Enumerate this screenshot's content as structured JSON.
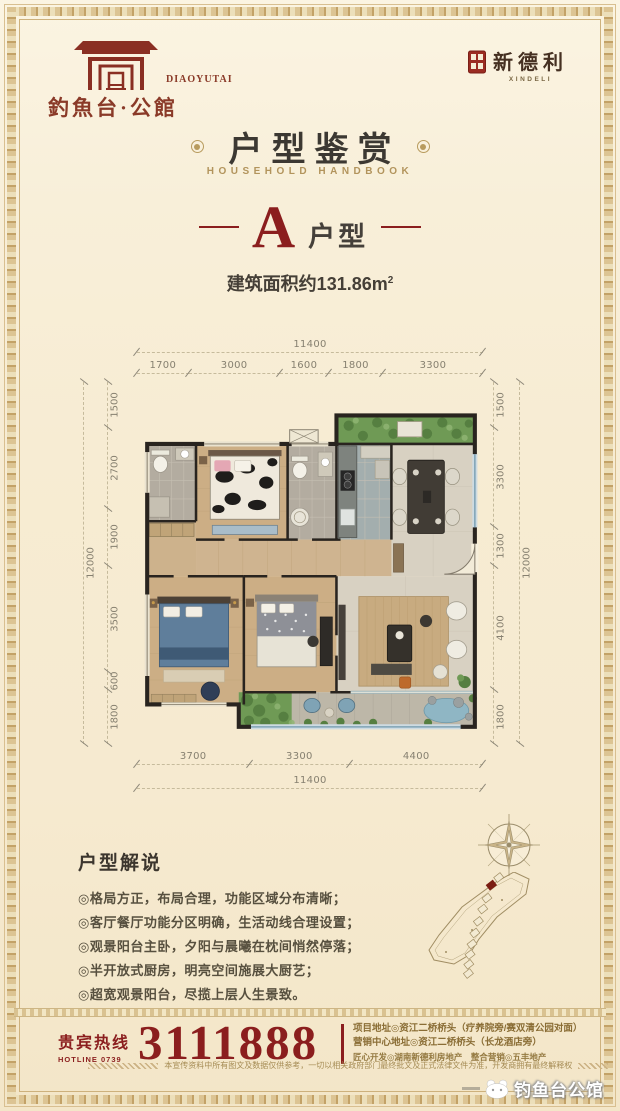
{
  "brand": {
    "gate_logo": {
      "cn": "釣魚台·公館",
      "en": "DIAOYUTAI"
    },
    "seal_logo": {
      "cn": "新德利",
      "en": "XINDELI"
    }
  },
  "title": {
    "cn": "户型鉴赏",
    "en": "HOUSEHOLD HANDBOOK"
  },
  "unit": {
    "letter": "A",
    "label": "户型",
    "area": "建筑面积约131.86m",
    "area_sup": "2"
  },
  "floorplan": {
    "dims_top": {
      "total": "11400",
      "segments": [
        "1700",
        "3000",
        "1600",
        "1800",
        "3300"
      ]
    },
    "dims_left": {
      "total": "12000",
      "segments": [
        "1500",
        "2700",
        "1900",
        "3500",
        "600",
        "1800"
      ]
    },
    "dims_right": {
      "total": "12000",
      "segments": [
        "1500",
        "3300",
        "1300",
        "4100",
        "1800"
      ]
    },
    "dims_bottom": {
      "total": "11400",
      "segments": [
        "3700",
        "3300",
        "4400"
      ]
    }
  },
  "description": {
    "heading": "户型解说",
    "bullets": [
      "◎格局方正，布局合理，功能区域分布清晰；",
      "◎客厅餐厅功能分区明确，生活动线合理设置；",
      "◎观景阳台主卧，夕阳与晨曦在枕间悄然停落；",
      "◎半开放式厨房，明亮空间施展大厨艺；",
      "◎超宽观景阳台，尽揽上层人生景致。"
    ]
  },
  "footer": {
    "hotline_label": "贵宾热线",
    "hotline_sub": "HOTLINE 0739",
    "hotline_number": "3111888",
    "info_lines": [
      "项目地址◎资江二桥桥头（疗养院旁/赛双清公园对面）",
      "营销中心地址◎资江二桥桥头（长龙酒店旁）",
      "匠心开发◎湖南新德利房地产　整合营销◎五丰地产"
    ],
    "disclaimer": "本宣传资料中所有图文及数据仅供参考，一切以相关政府部门最终批文及正式法律文件为准，开发商拥有最终解释权"
  },
  "watermark": {
    "text": "钓鱼台公馆"
  },
  "colors": {
    "maroon": "#8b1e1e",
    "gold": "#a8863f",
    "cream": "#f7eed6",
    "dark_text": "#3c3630"
  }
}
